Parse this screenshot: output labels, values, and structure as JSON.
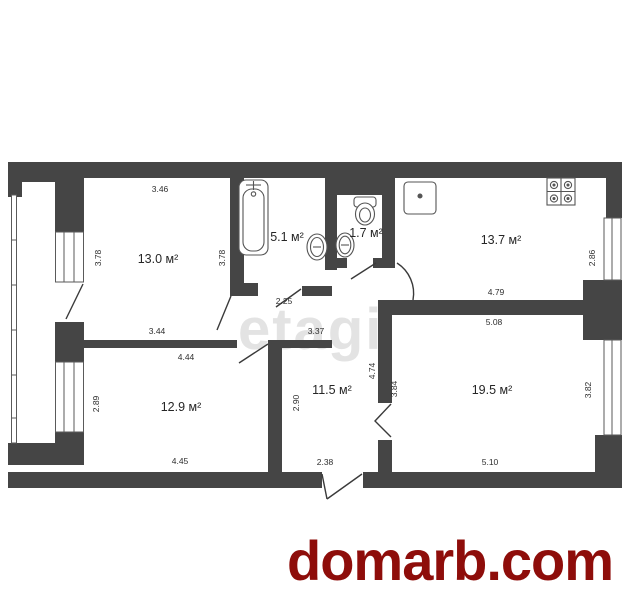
{
  "site_watermark": {
    "text": "domarb.com",
    "color": "#8e0d0a",
    "x": 287,
    "y": 528
  },
  "agency_watermark": {
    "text": "etagi",
    "color": "#e3e3e3",
    "x": 238,
    "y": 296
  },
  "plan": {
    "wall_color": "#454545",
    "line_color": "#5a5a5a",
    "rooms": [
      {
        "id": "room-13-0",
        "area_label": "13.0 м²",
        "x": 158,
        "y": 259,
        "dims": [
          {
            "t": "3.46",
            "x": 160,
            "y": 189,
            "rot": 0
          },
          {
            "t": "3.78",
            "x": 98,
            "y": 258,
            "rot": -90
          },
          {
            "t": "3.78",
            "x": 222,
            "y": 258,
            "rot": -90
          },
          {
            "t": "3.44",
            "x": 157,
            "y": 331,
            "rot": 0
          }
        ]
      },
      {
        "id": "bathroom",
        "area_label": "5.1 м²",
        "x": 287,
        "y": 237,
        "dims": [
          {
            "t": "2.25",
            "x": 284,
            "y": 301,
            "rot": 0
          }
        ]
      },
      {
        "id": "wc",
        "area_label": "1.7 м²",
        "x": 366,
        "y": 233,
        "dims": []
      },
      {
        "id": "kitchen",
        "area_label": "13.7 м²",
        "x": 501,
        "y": 240,
        "dims": [
          {
            "t": "2.86",
            "x": 592,
            "y": 258,
            "rot": -90
          },
          {
            "t": "4.79",
            "x": 496,
            "y": 292,
            "rot": 0
          }
        ]
      },
      {
        "id": "room-12-9",
        "area_label": "12.9 м²",
        "x": 181,
        "y": 407,
        "dims": [
          {
            "t": "4.44",
            "x": 186,
            "y": 357,
            "rot": 0
          },
          {
            "t": "2.89",
            "x": 96,
            "y": 404,
            "rot": -90
          },
          {
            "t": "2.90",
            "x": 296,
            "y": 403,
            "rot": -90
          },
          {
            "t": "4.45",
            "x": 180,
            "y": 461,
            "rot": 0
          }
        ]
      },
      {
        "id": "hallway",
        "area_label": "11.5 м²",
        "x": 332,
        "y": 390,
        "dims": [
          {
            "t": "3.37",
            "x": 316,
            "y": 331,
            "rot": 0
          },
          {
            "t": "4.74",
            "x": 372,
            "y": 371,
            "rot": -90
          },
          {
            "t": "3.84",
            "x": 394,
            "y": 389,
            "rot": -90
          },
          {
            "t": "2.38",
            "x": 325,
            "y": 462,
            "rot": 0
          }
        ]
      },
      {
        "id": "room-19-5",
        "area_label": "19.5 м²",
        "x": 492,
        "y": 390,
        "dims": [
          {
            "t": "5.08",
            "x": 494,
            "y": 322,
            "rot": 0
          },
          {
            "t": "3.82",
            "x": 588,
            "y": 390,
            "rot": -90
          },
          {
            "t": "5.10",
            "x": 490,
            "y": 462,
            "rot": 0
          }
        ]
      }
    ]
  }
}
